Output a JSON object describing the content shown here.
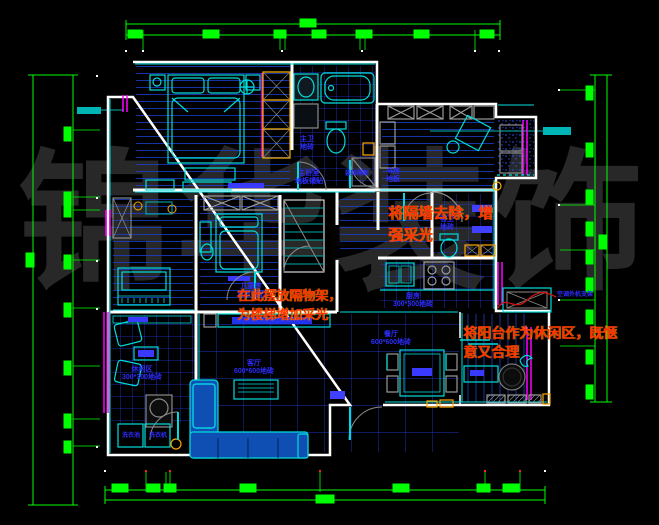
{
  "watermark": "锦华装饰",
  "annotations": {
    "remove_wall": "将隔墙去除，增\n强采光",
    "shelf_stairs": "在此摆放隔物架，\n为楼梯增加采光",
    "balcony_leisure": "将阳台作为休闲区，既惬\n意又合理"
  },
  "labels": {
    "master_bedroom": "主卧室\n地板铺贴",
    "master_bath": "主卫\n地砖",
    "hall_divider": "装饰隔断",
    "study": "书房\n地板",
    "kids_room": "儿童房\n地板铺贴",
    "guest_bath": "客卫\n地砖",
    "kitchen": "厨房\n300*300地砖",
    "living_room": "客厅\n600*600地砖",
    "dining_room": "餐厅\n600*600地砖",
    "leisure_room": "休闲区\n300*300地砖",
    "ac_bracket": "空调外机支架",
    "laundry_sink": "洗衣池",
    "washing_machine": "洗衣机"
  },
  "colors": {
    "background": "#000000",
    "walls": "#ffffff",
    "furniture": "#00dcdc",
    "hatch_blue": "#2038d8",
    "dimension_green": "#00ff00",
    "window_magenta": "#ff00ff",
    "annotation_red": "#ff3400",
    "label_blue": "#2d2dff",
    "accent_yellow": "#ffa800",
    "watermark_gray": "#282828"
  }
}
